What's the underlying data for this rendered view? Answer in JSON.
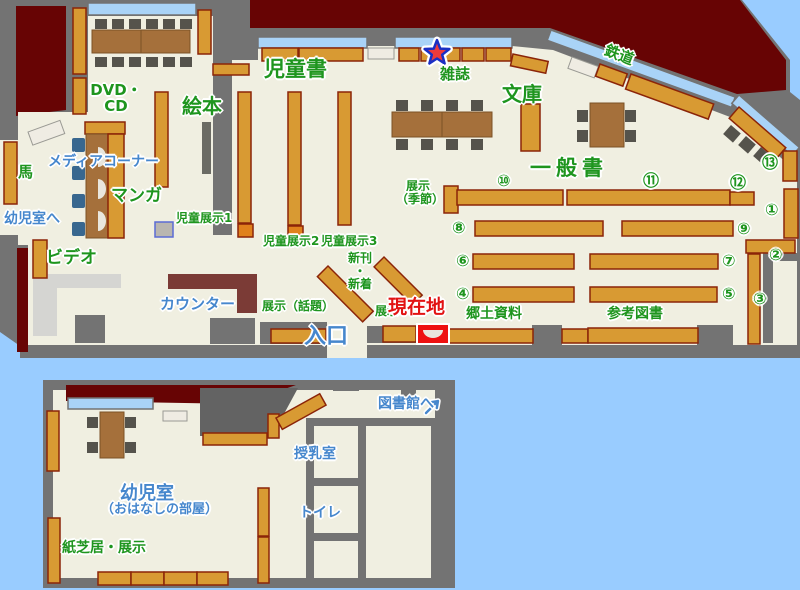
{
  "title": "library-floor-map",
  "colors": {
    "background": "#99ccff",
    "exterior": "#670404",
    "wall": "#737373",
    "floor": "#f0efe1",
    "shelf": "#d89a33",
    "window": "#a9d3f7",
    "counter": "#7b3b36",
    "label_green": "#1e951e",
    "label_blue": "#4687cd",
    "current_location_red": "#ee1111"
  },
  "icons": {
    "star": "magazine-star-marker",
    "current_location": "current-location-marker",
    "arrow": "to-library-arrow"
  },
  "labels": {
    "dvd_line1": "DVD・",
    "dvd_line2": "CD",
    "ehon": "絵本",
    "jidousho": "児童書",
    "zasshi": "雑誌",
    "bunko": "文庫",
    "tetsudou": "鉄道",
    "uma": "馬",
    "media_corner": "メディアコーナー",
    "manga": "マンガ",
    "yoji_e": "幼児室へ",
    "video": "ビデオ",
    "counter": "カウンター",
    "jido_tenji1": "児童展示1",
    "jido_tenji2": "児童展示2",
    "jido_tenji3": "児童展示3",
    "shinkan": "新刊",
    "nakaguro": "・",
    "shinchaku": "新着",
    "tenji_wadai": "展示（話題）",
    "tenji": "展示",
    "genzaichi": "現在地",
    "iriguchi": "入口",
    "kyodo": "郷土資料",
    "sankou": "参考図書",
    "ippan": "一般書",
    "kisetsu1": "展示",
    "kisetsu2": "（季節）"
  },
  "numbers": [
    "①",
    "②",
    "③",
    "④",
    "⑤",
    "⑥",
    "⑦",
    "⑧",
    "⑨",
    "⑩",
    "⑪",
    "⑫",
    "⑬"
  ],
  "annex": {
    "toshokan_e": "図書館へ",
    "junyu": "授乳室",
    "toire": "トイレ",
    "yojishitsu": "幼児室",
    "ohanashi": "（おはなしの部屋）",
    "kamishibai": "紙芝居・展示"
  }
}
